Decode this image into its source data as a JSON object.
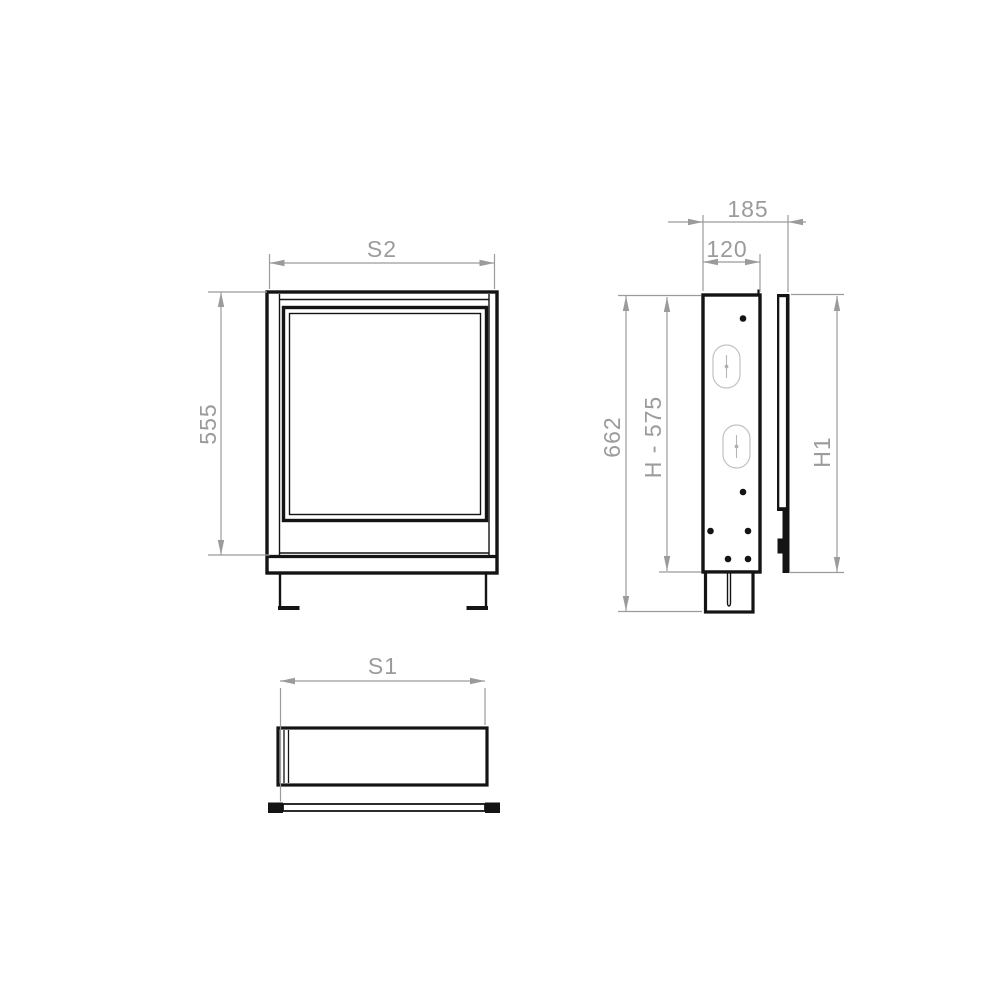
{
  "drawing": {
    "kind": "technical-dimension-drawing",
    "colors": {
      "outline": "#141414",
      "dimension": "#9b9b9b",
      "detail_light": "#c2c2c2",
      "background": "#ffffff"
    }
  },
  "dims": {
    "front_width": "S2",
    "front_height": "555",
    "side_depth_total": "185",
    "side_depth_body": "120",
    "side_height_total": "662",
    "side_height_body": "H - 575",
    "side_height_frame": "H1",
    "top_width": "S1"
  }
}
